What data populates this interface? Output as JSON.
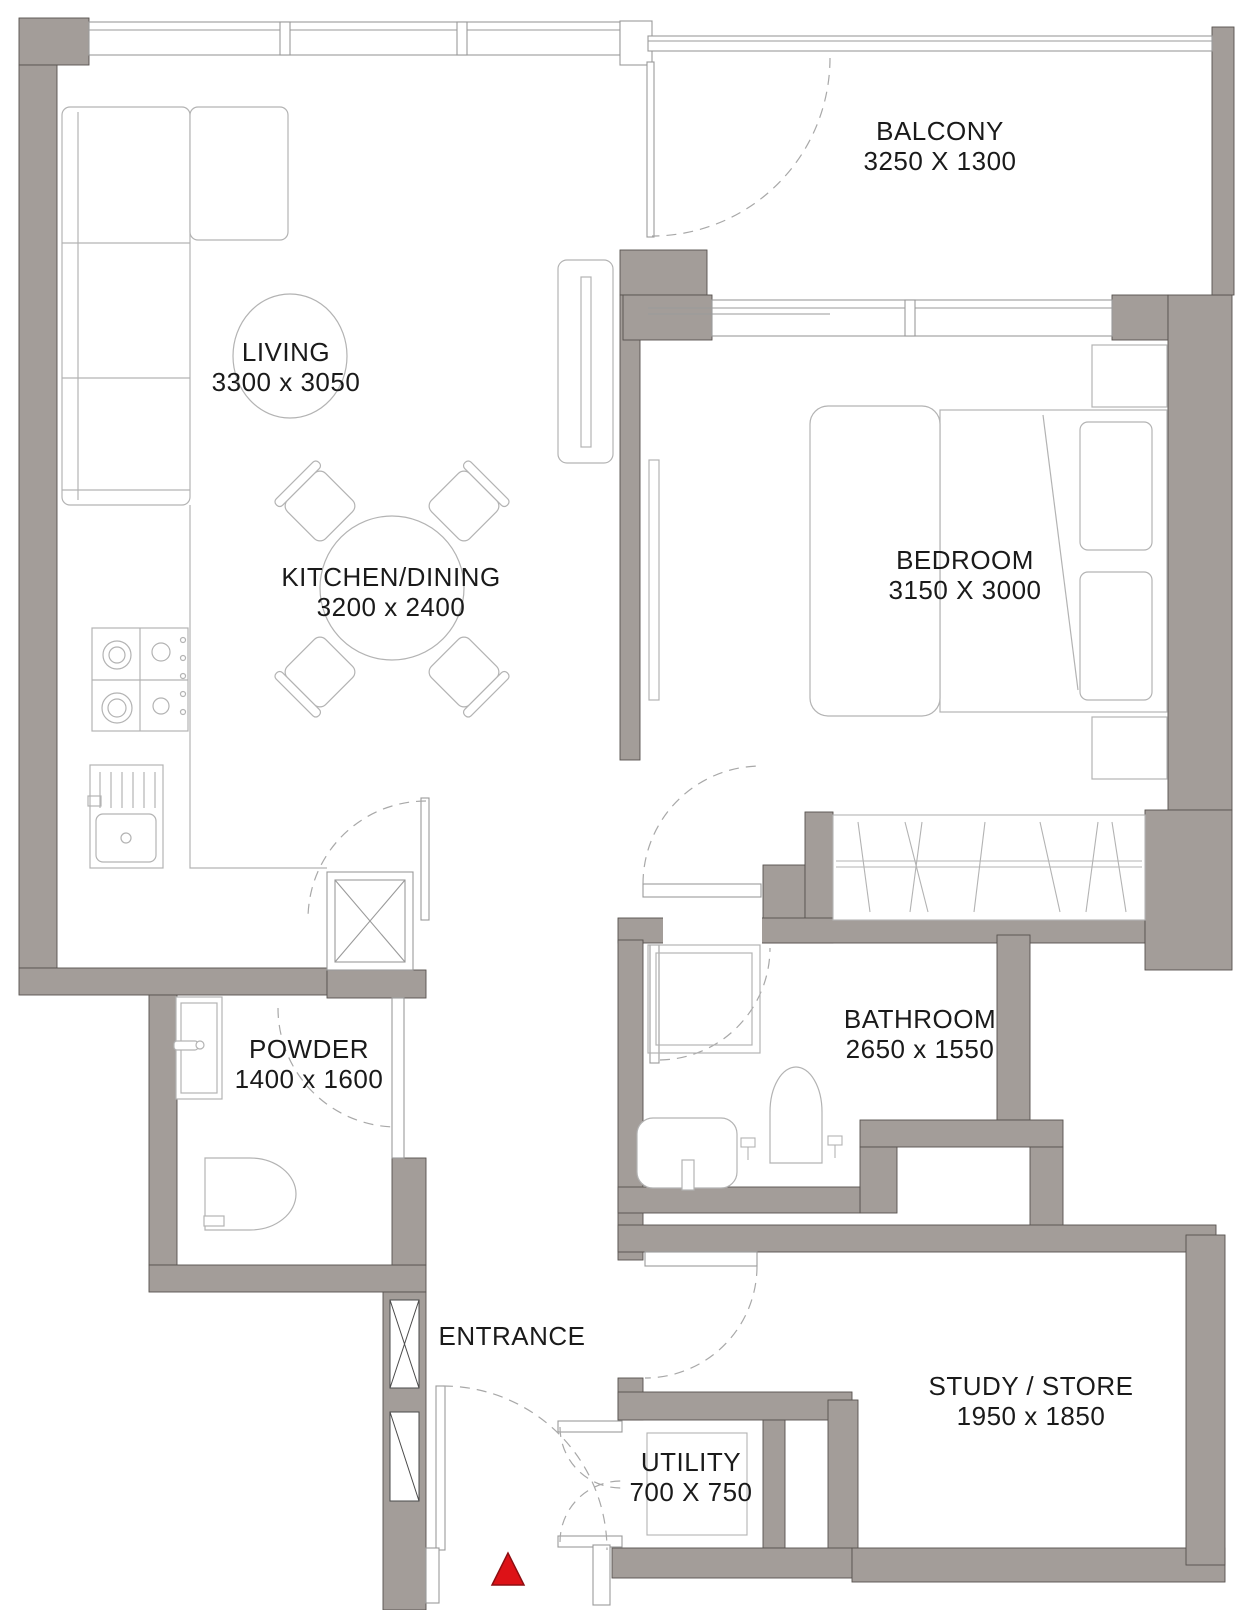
{
  "rooms": {
    "balcony": {
      "name": "BALCONY",
      "dims": "3250 X 1300"
    },
    "living": {
      "name": "LIVING",
      "dims": "3300 x 3050"
    },
    "kitchen": {
      "name": "KITCHEN/DINING",
      "dims": "3200 x 2400"
    },
    "bedroom": {
      "name": "BEDROOM",
      "dims": "3150 X 3000"
    },
    "bathroom": {
      "name": "BATHROOM",
      "dims": "2650 x 1550"
    },
    "powder": {
      "name": "POWDER",
      "dims": "1400 x 1600"
    },
    "entrance": {
      "name": "ENTRANCE"
    },
    "utility": {
      "name": "UTILITY",
      "dims": "700 X 750"
    },
    "study": {
      "name": "STUDY / STORE",
      "dims": "1950 x 1850"
    }
  },
  "colors": {
    "wall": "#a39d99",
    "wall_edge": "#57524e",
    "line": "#b3b3b3",
    "dark_line": "#4a4a4a",
    "text": "#1a1a1a",
    "entrance_marker": "#dd1217"
  }
}
